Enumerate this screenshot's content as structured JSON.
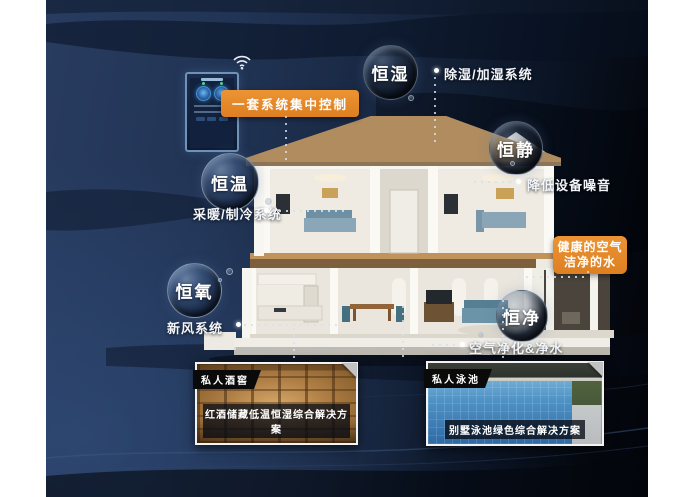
{
  "poster": {
    "control_tag": "一套系统集中控制",
    "highlight": {
      "line1": "健康的空气",
      "line2": "洁净的水"
    },
    "bubbles": [
      {
        "label": "恒湿",
        "note": "除湿/加湿系统"
      },
      {
        "label": "恒静",
        "note": "降低设备噪音"
      },
      {
        "label": "恒温",
        "note": "采暖/制冷系统"
      },
      {
        "label": "恒氧",
        "note": "新风系统"
      },
      {
        "label": "恒净",
        "note": "空气净化&净水"
      }
    ],
    "photos": [
      {
        "badge": "私人酒窖",
        "caption": "红酒储藏低温恒湿综合解决方案"
      },
      {
        "badge": "私人泳池",
        "caption": "别墅泳池绿色综合解决方案"
      }
    ],
    "icons": {
      "wifi": "wifi-icon"
    },
    "colors": {
      "accent_orange": "#E2862A",
      "background_navy": "#20324F",
      "background_black": "#05080D",
      "text": "#FFFFFF"
    }
  }
}
